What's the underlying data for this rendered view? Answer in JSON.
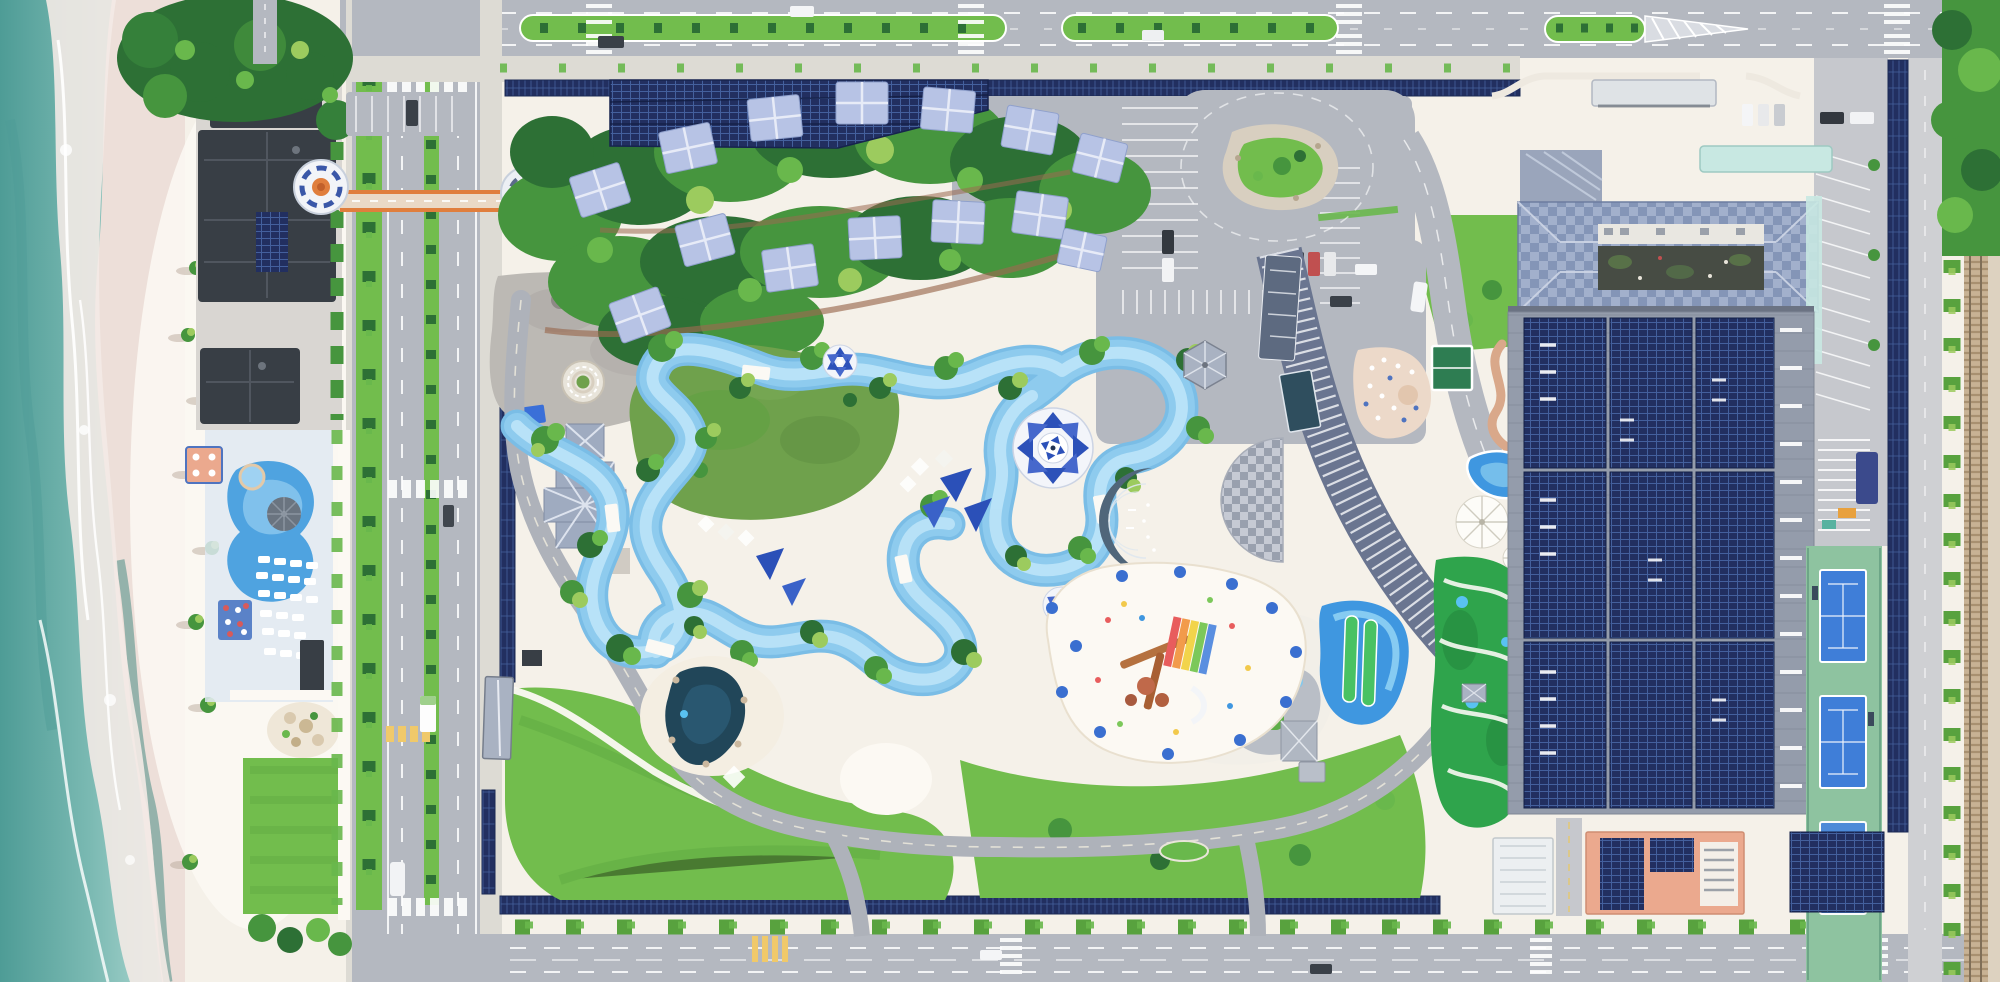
{
  "meta": {
    "type": "aerial-drone-photo",
    "subject": "Top-down aerial view of a beachfront water park and resort complex between a beach and a railway line",
    "canvas": {
      "width": 2000,
      "height": 982
    }
  },
  "palette": {
    "sand": "#f5f1e9",
    "sandBright": "#fcf9f3",
    "wetSand": "#eddfd9",
    "oceanDeep": "#4e9c96",
    "ocean": "#7ab9b2",
    "oceanPale": "#abd6d0",
    "foam": "#f3eae6",
    "asphalt": "#b4b8c0",
    "asphaltLight": "#c6c8cd",
    "roadInner": "#aeb2ba",
    "sidewalk": "#dddbd4",
    "line": "#ffffff",
    "grass": "#72bd4d",
    "grassDark": "#58a23e",
    "grassOlive": "#6fa14c",
    "treeDark": "#2d7035",
    "tree": "#46953e",
    "treeLight": "#69b84c",
    "treeLime": "#9ccb5e",
    "river": "#8ecbee",
    "riverLight": "#bce4f8",
    "riverDeep": "#7abde6",
    "lagoon": "#214659",
    "solarDark": "#222f60",
    "solarLine": "#44609d",
    "cabana": "#b7c3e5",
    "cabanaRidge": "#e7ebf7",
    "roofDark": "#383e45",
    "roofGray": "#a9b2c2",
    "hipRoof": "#8495b7",
    "hipRoofLight": "#a2b0cc",
    "orange": "#e07e3d",
    "terracotta": "#eba98e",
    "mint": "#c8e8e2",
    "tealGlass": "#2f4e5e",
    "hotelBand": "#6a7590",
    "checkA": "#c6cad4",
    "checkB": "#99a0ae",
    "crescent": "#50667a",
    "plazaGray": "#bcb9b4",
    "golf": "#2fa44c",
    "golfBright": "#49c263",
    "courtBlue": "#3f7ed8",
    "courtGreen": "#8ec3a0",
    "railBase": "#c8b294",
    "salmon": "#d9a88a",
    "terrace": "#ecd9c9",
    "slideBlue": "#3f97e0",
    "skyBlue": "#59c2f2",
    "navy": "#1b2a55"
  },
  "scene": {
    "ocean": {
      "label": "Sea with breaking surf and foam"
    },
    "beach": {
      "label": "White sand beach with palm trees"
    },
    "beachClub": {
      "label": "Beachfront club with dark roofs, kidney pool, parasol and sun loungers"
    },
    "bridge": {
      "label": "Orange pedestrian bridge with two circular towers crossing the coastal road"
    },
    "coastalRoad": {
      "label": "Coastal boulevard with planted median and crosswalks"
    },
    "topRoad": {
      "label": "Northern boulevard with planted medians and chevron island"
    },
    "bottomRoad": {
      "label": "Southern boulevard with street trees and crossings"
    },
    "eastRoad": {
      "label": "Eastern service road beside solar walkway and railway"
    },
    "solarCanopies": {
      "label": "Dark-blue roadside solar panel canopy strips"
    },
    "solarArray": {
      "label": "Large ground-mounted solar array north of the cabanas"
    },
    "cabanaGrove": {
      "label": "Two arcs of blue-roofed cabanas in dense tropical trees",
      "count": 14
    },
    "plaza": {
      "label": "Entry plaza with circular ringed planter"
    },
    "pavilion": {
      "label": "Cross-gabled gray pavilion with small square pavilion"
    },
    "entranceBuilding": {
      "label": "Long gable-roofed gate building on the internal road"
    },
    "lazyRiver": {
      "label": "Winding pale-blue lazy river pool looping through gardens"
    },
    "centralLawn": {
      "label": "Large central event lawn ringed by the river"
    },
    "shadeCanopies": {
      "label": "Blue and white geometric flower shade canopies",
      "count": 3
    },
    "sailShades": {
      "label": "Blue sail shades and white tents over splash areas"
    },
    "lagoon": {
      "label": "Dark rock-lined lagoon pond with sand surround"
    },
    "kidsPlayground": {
      "label": "Colorful children's splash playground with rainbow slide on white sand"
    },
    "crescent": {
      "label": "Dark crescent-shaped splash stage with white markings"
    },
    "checkerPlaza": {
      "label": "Checkered semicircular plaza at hotel front"
    },
    "gazebo": {
      "label": "Hexagonal gray gazebo"
    },
    "hotel": {
      "label": "Curved hotel block with white louvered roof bands"
    },
    "rooftopTerrace": {
      "label": "Rooftop terrace with loungers"
    },
    "rooftopCourt": {
      "label": "White-framed green rooftop court"
    },
    "amenityStrip": {
      "label": "Pools, slides and canopy umbrellas between hotel and hall"
    },
    "miniGolf": {
      "label": "Bright mini-golf greens with winding white paths"
    },
    "parkingNorth": {
      "label": "North parking lots with marked stalls and parked cars"
    },
    "teardrop": {
      "label": "Teardrop turning loop with gravel rock garden island"
    },
    "conventionHall": {
      "label": "Hip-roofed hall with patterned blue roof and inner courtyard"
    },
    "solarBuilding": {
      "label": "Huge hall roofed almost entirely with solar panels"
    },
    "tennis": {
      "label": "Blue tennis courts on green apron",
      "count": 2
    },
    "sideParking": {
      "label": "Angled parking bays along the east apron"
    },
    "railway": {
      "label": "Railway line with sleepers beside scrub strip"
    },
    "terracottaBuilding": {
      "label": "Terracotta-roofed building with rooftop solar panels"
    },
    "whiteBuilding": {
      "label": "Flat white-roofed service building"
    },
    "lawns": {
      "label": "Open mowed lawns crossed by white footpaths"
    },
    "turnaround": {
      "label": "Small oval turnaround island on the park road"
    },
    "vehicles": {
      "label": "Cars, buses and trucks on roads and in stalls"
    }
  }
}
